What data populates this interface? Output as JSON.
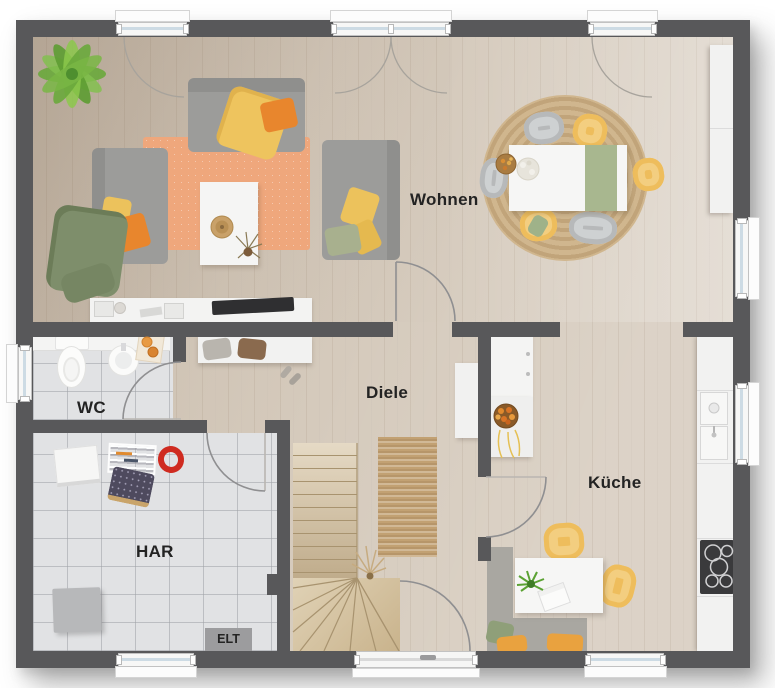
{
  "plan": {
    "room_labels": [
      {
        "id": "wohnen",
        "label": "Wohnen"
      },
      {
        "id": "diele",
        "label": "Diele"
      },
      {
        "id": "kueche",
        "label": "Küche"
      },
      {
        "id": "wc",
        "label": "WC"
      },
      {
        "id": "har",
        "label": "HAR"
      },
      {
        "id": "elt",
        "label": "ELT"
      }
    ],
    "colors": {
      "wall": "#58585a",
      "wood_floor": "#d5cabc",
      "tile_floor": "#e1e2e4",
      "stair_wood": "#d8c6a6",
      "rug_living_orange": "#efa77c",
      "rug_jute": "#c6ab80",
      "sofa_gray": "#9c9c9a",
      "pillow_orange": "#e8862d",
      "pillow_yellow": "#ecc25c",
      "blanket_green": "#7e8e6b",
      "chair_gray": "#b7b9ba",
      "chair_yellow": "#eebd5c",
      "table_white": "#f6f6f5",
      "counter_white": "#f2f2f1",
      "cooktop_dark": "#3a3a3c",
      "bench_gray": "#a9a7a1",
      "plant_green": "#6aa93c",
      "label_text": "#232323"
    }
  }
}
